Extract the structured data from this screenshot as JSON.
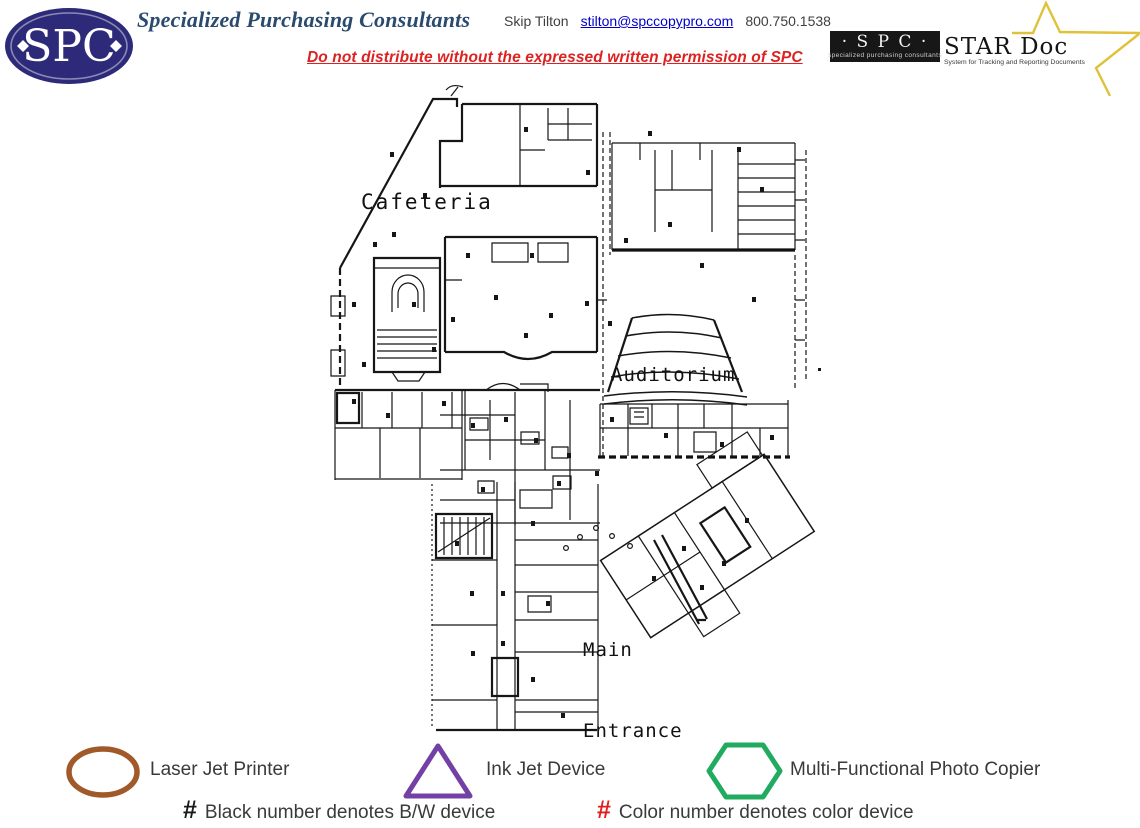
{
  "header": {
    "logo_text": "SPC",
    "title": "Specialized Purchasing Consultants",
    "title_color": "#2A4A6E",
    "contact": {
      "name": "Skip Tilton",
      "email": "stilton@spccopypro.com",
      "phone": "800.750.1538"
    },
    "warning": {
      "text": "Do not distribute without the expressed written permission of SPC",
      "color": "#DD2222"
    },
    "stardoc": {
      "spc_label": "· S P C ·",
      "spc_sub": "specialized purchasing consultants",
      "product": "STAR Doc",
      "tagline": "System for Tracking and Reporting Documents",
      "star_color": "#DFC23A"
    },
    "logo_color": "#2D2B79"
  },
  "floorplan": {
    "labels": {
      "cafeteria": "Cafeteria",
      "auditorium": "Auditorium",
      "main_line1": "Main",
      "main_line2": "Entrance"
    }
  },
  "legend": {
    "items": [
      {
        "shape": "oval",
        "color": "#A1592A",
        "label": "Laser Jet Printer"
      },
      {
        "shape": "triangle",
        "color": "#7340A6",
        "label": "Ink Jet Device"
      },
      {
        "shape": "hexagon",
        "color": "#21AB60",
        "label": "Multi-Functional Photo Copier"
      }
    ],
    "notes": [
      {
        "symbol": "#",
        "color": "#1A1A1A",
        "text": "Black number denotes B/W device"
      },
      {
        "symbol": "#",
        "color": "#E01F1F",
        "text": "Color number denotes color device"
      }
    ]
  }
}
